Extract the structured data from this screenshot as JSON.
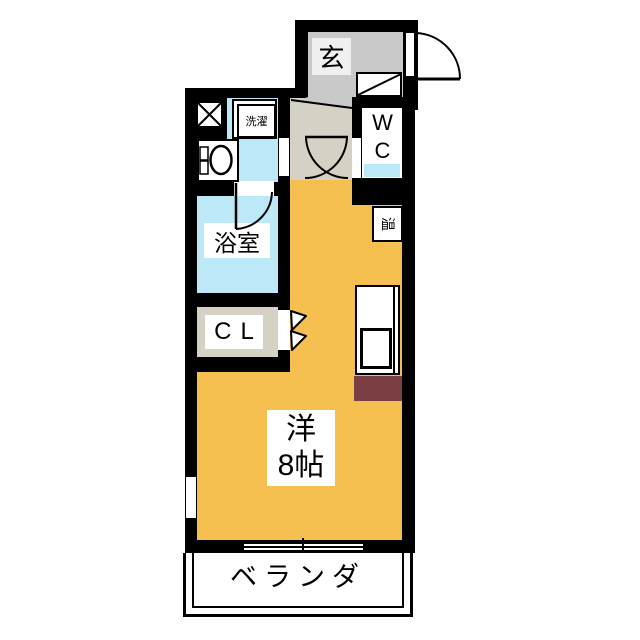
{
  "plan": {
    "type": "apartment-floor-plan",
    "labels": {
      "entrance": "玄",
      "laundry": "洗濯",
      "wc": "WC",
      "bathroom": "浴室",
      "closet": "CL",
      "water_heater": "温",
      "main_room_name": "洋",
      "main_room_size": "8帖",
      "veranda": "ベランダ"
    },
    "colors": {
      "wall": "#000000",
      "main_room_orange": "#F6C050",
      "wet_area_blue": "#BDE8F7",
      "entrance_tile_gray": "#C9C9C9",
      "hallway_beige": "#D5D1C4",
      "refrigerator_space_brown": "#7B3E42",
      "background": "#FFFFFF"
    }
  }
}
